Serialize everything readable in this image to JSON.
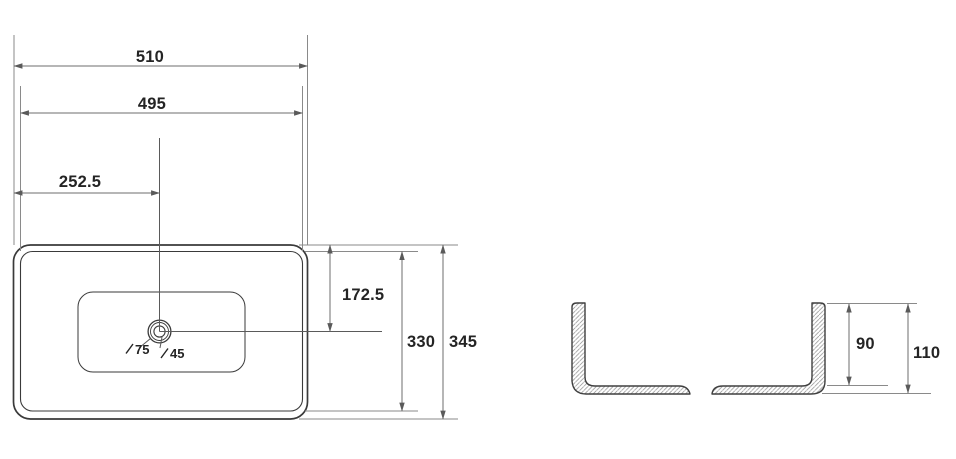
{
  "drawing": {
    "type": "technical-dimension-drawing",
    "subject": "rectangular countertop wash basin",
    "colors": {
      "background": "#ffffff",
      "object_line": "#3a3a3a",
      "dimension_line": "#6e6e6e",
      "text": "#242424",
      "hatch": "#9a9a9a"
    },
    "plan_view": {
      "dimensions": {
        "overall_width": "510",
        "rim_width": "495",
        "drain_center_from_left": "252.5",
        "drain_center_from_top": "172.5",
        "rim_depth": "330",
        "overall_depth": "345",
        "drain_outer_hole": "75",
        "drain_inner_hole": "45"
      }
    },
    "section_view": {
      "dimensions": {
        "inner_depth": "90",
        "overall_height": "110"
      }
    }
  }
}
